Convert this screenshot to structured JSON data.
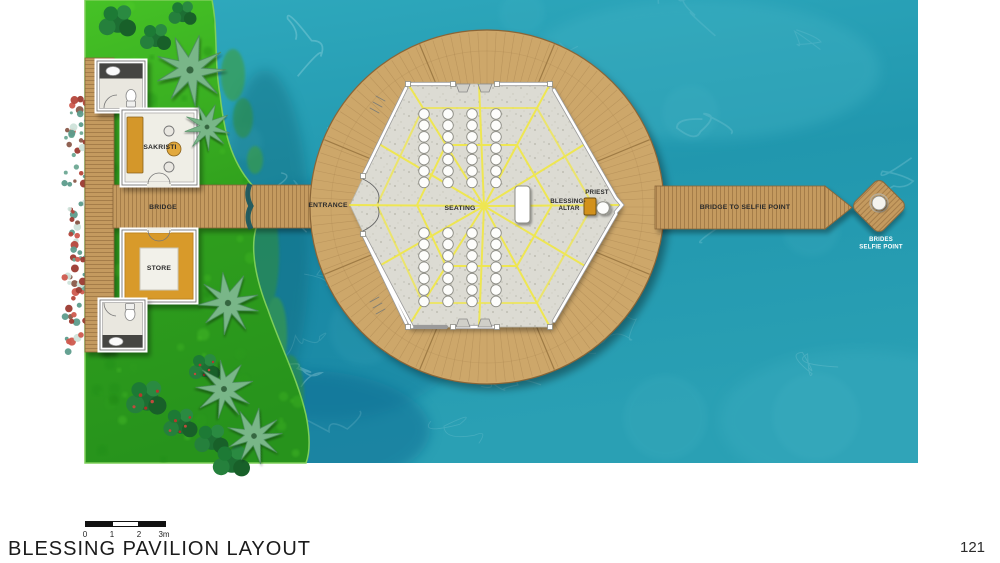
{
  "meta": {
    "title_label": "BLESSING PAVILION LAYOUT",
    "page_number": "121"
  },
  "scale_bar": {
    "tick0": "0",
    "tick1": "1",
    "tick2": "2",
    "tick3": "3m"
  },
  "plan": {
    "labels": {
      "bridge": "BRIDGE",
      "sakristi": "SAKRISTI",
      "store": "STORE",
      "entrance": "ENTRANCE",
      "seating": "SEATING",
      "blessing_altar_line1": "BLESSING-",
      "blessing_altar_line2": "ALTAR",
      "priest": "PRIEST",
      "bridge_to_selfie": "BRIDGE TO SELFIE POINT",
      "brides_selfie_line1": "BRIDES",
      "brides_selfie_line2": "SELFIE POINT"
    },
    "colors": {
      "water": "#2aa3b6",
      "water_deep": "#0e7397",
      "lawn": "#39ae1f",
      "wood": "#c49a5e",
      "deck_wood": "#cda76b",
      "concrete": "#dcdbd3",
      "accent_yellow": "#f2e93c",
      "altar_orange": "#d2911f"
    },
    "seating": {
      "blocks": [
        {
          "columns_x": [
            424,
            448,
            472,
            496
          ],
          "start_y": 114,
          "step_y": 11.4,
          "chairs_per_column": 7
        },
        {
          "columns_x": [
            424,
            448,
            472,
            496
          ],
          "start_y": 233,
          "step_y": 11.4,
          "chairs_per_column": 7
        }
      ],
      "chair_radius": 5.3
    }
  }
}
